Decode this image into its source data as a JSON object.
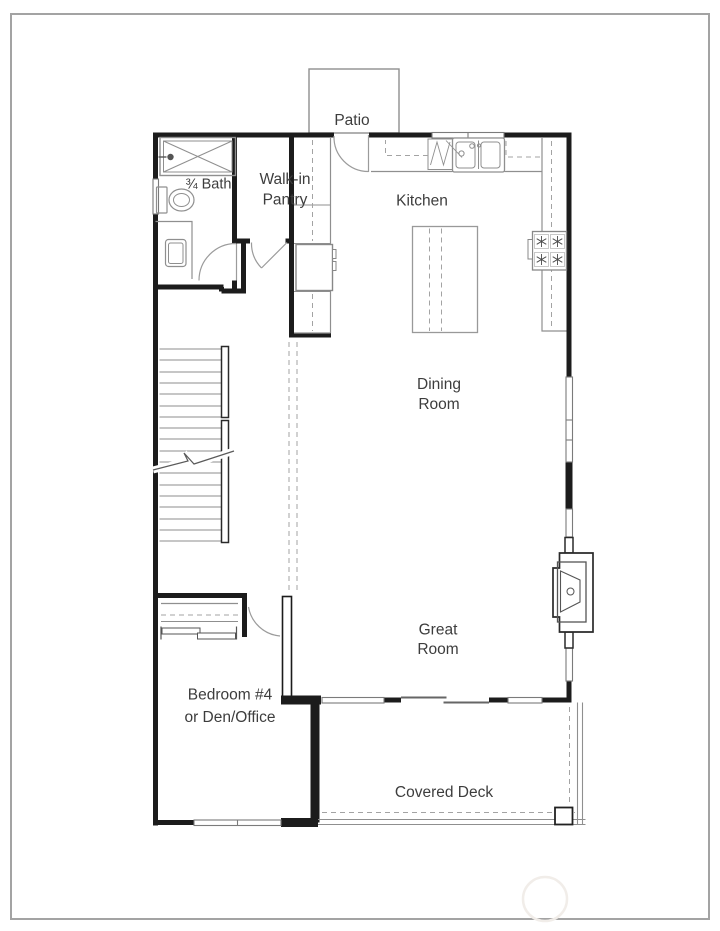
{
  "plan": {
    "type": "floor-plan",
    "rooms": {
      "patio": {
        "label": "Patio"
      },
      "bath": {
        "label": "¾ Bath"
      },
      "pantry": {
        "line1": "Walk-in",
        "line2": "Pantry"
      },
      "kitchen": {
        "label": "Kitchen"
      },
      "dining_room": {
        "line1": "Dining",
        "line2": "Room"
      },
      "great_room": {
        "line1": "Great",
        "line2": "Room"
      },
      "bedroom": {
        "line1": "Bedroom #4",
        "line2": "or Den/Office"
      },
      "covered_deck": {
        "label": "Covered Deck"
      }
    },
    "colors": {
      "background": "#ffffff",
      "frame": "#a3a3a3",
      "walls": "#1c1c1c",
      "fixtures": "#8f8f8f",
      "windows": "#7b7b7b",
      "dashed_lines": "#a3a3a3",
      "text": "#3d3d3d"
    }
  }
}
